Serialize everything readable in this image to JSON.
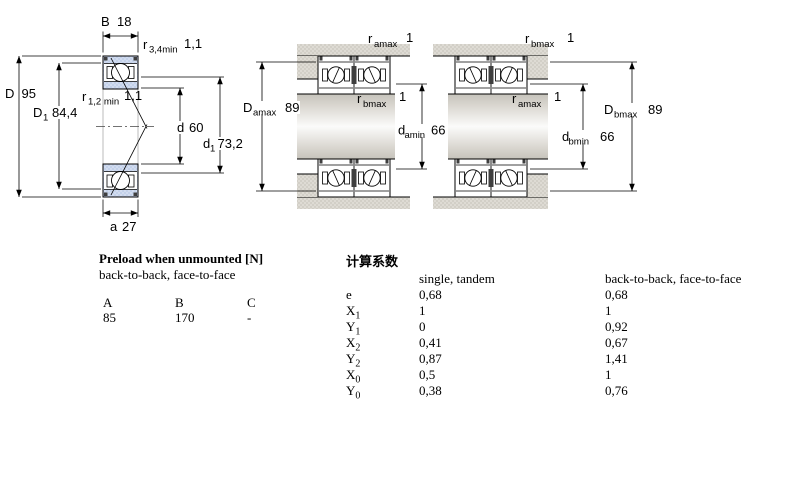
{
  "drawing": {
    "left": {
      "B": {
        "sym": "B",
        "val": "18"
      },
      "r34": {
        "sym": "r",
        "sub": "3,4min",
        "val": "1,1"
      },
      "D": {
        "sym": "D",
        "val": "95"
      },
      "D1": {
        "sym": "D",
        "sub": "1",
        "val": "84,4"
      },
      "r12": {
        "sym": "r",
        "sub": "1,2 min",
        "val": "1,1"
      },
      "d": {
        "sym": "d",
        "val": "60"
      },
      "d1": {
        "sym": "d",
        "sub": "1",
        "val": "73,2"
      },
      "a": {
        "sym": "a",
        "val": "27"
      }
    },
    "middle": {
      "ramax": {
        "sym": "r",
        "sub": "amax",
        "val": "1"
      },
      "rbmax": {
        "sym": "r",
        "sub": "bmax",
        "val": "1"
      },
      "Damax": {
        "sym": "D",
        "sub": "amax",
        "val": "89"
      },
      "damin": {
        "sym": "d",
        "sub": "amin",
        "val": "66"
      }
    },
    "right": {
      "rbmax": {
        "sym": "r",
        "sub": "bmax",
        "val": "1"
      },
      "ramax": {
        "sym": "r",
        "sub": "amax",
        "val": "1"
      },
      "Dbmax": {
        "sym": "D",
        "sub": "bmax",
        "val": "89"
      },
      "dbmin": {
        "sym": "d",
        "sub": "bmin",
        "val": "66"
      }
    }
  },
  "preload_table": {
    "title": "Preload when unmounted [N]",
    "subtitle": "back-to-back, face-to-face",
    "columns": [
      "A",
      "B",
      "C"
    ],
    "values": [
      "85",
      "170",
      "-"
    ]
  },
  "factors_table": {
    "title": "计算系数",
    "col1_header": "single, tandem",
    "col2_header": "back-to-back, face-to-face",
    "rows": [
      {
        "sym": "e",
        "sub": "",
        "single": "0,68",
        "paired": "0,68"
      },
      {
        "sym": "X",
        "sub": "1",
        "single": "1",
        "paired": "1"
      },
      {
        "sym": "Y",
        "sub": "1",
        "single": "0",
        "paired": "0,92"
      },
      {
        "sym": "X",
        "sub": "2",
        "single": "0,41",
        "paired": "0,67"
      },
      {
        "sym": "Y",
        "sub": "2",
        "single": "0,87",
        "paired": "1,41"
      },
      {
        "sym": "X",
        "sub": "0",
        "single": "0,5",
        "paired": "1"
      },
      {
        "sym": "Y",
        "sub": "0",
        "single": "0,38",
        "paired": "0,76"
      }
    ]
  },
  "colors": {
    "bearing_fill": "#c9d6ec",
    "housing_fill": "#d8d5cd",
    "line": "#000000"
  }
}
